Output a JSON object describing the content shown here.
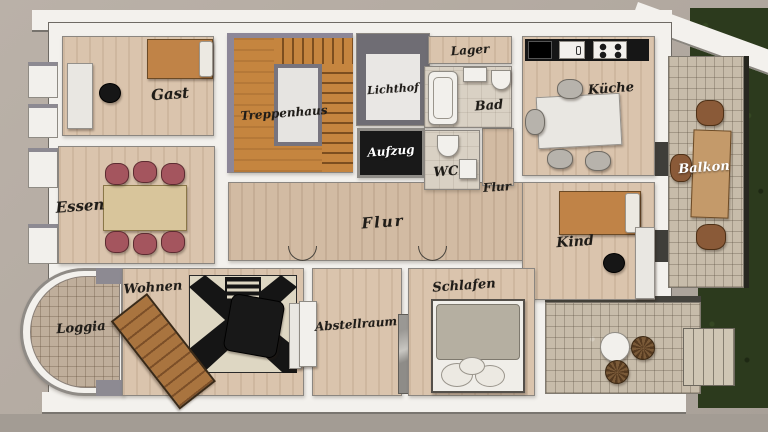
{
  "plan": {
    "type": "apartment-floor-plan",
    "labels": {
      "gast": "Gast",
      "treppenhaus": "Treppenhaus",
      "lichthof": "Lichthof",
      "aufzug": "Aufzug",
      "lager": "Lager",
      "bad": "Bad",
      "wc": "WC",
      "flur_right": "Flur",
      "kueche": "Küche",
      "balkon": "Balkon",
      "kind": "Kind",
      "essen": "Essen",
      "flur_main": "Flur",
      "wohnen": "Wohnen",
      "loggia": "Loggia",
      "abstellraum": "Abstellraum",
      "schlafen": "Schlafen"
    },
    "colors": {
      "background": "#b3aaa1",
      "wall_white": "#f3f1ed",
      "wood_floor": "#dac4ad",
      "stair_wood": "#c5853f",
      "elevator": "#191919",
      "bath_tile": "#d9d1c4",
      "stone_tile": "#c7bcaa",
      "grass": "#2c3a1d",
      "dining_chair": "#a4555e",
      "bed_orange": "#c08347",
      "bed_gray_blanket": "#b5afa1",
      "balcony_chair": "#8a5a38",
      "kitchen_counter": "#161616"
    }
  }
}
